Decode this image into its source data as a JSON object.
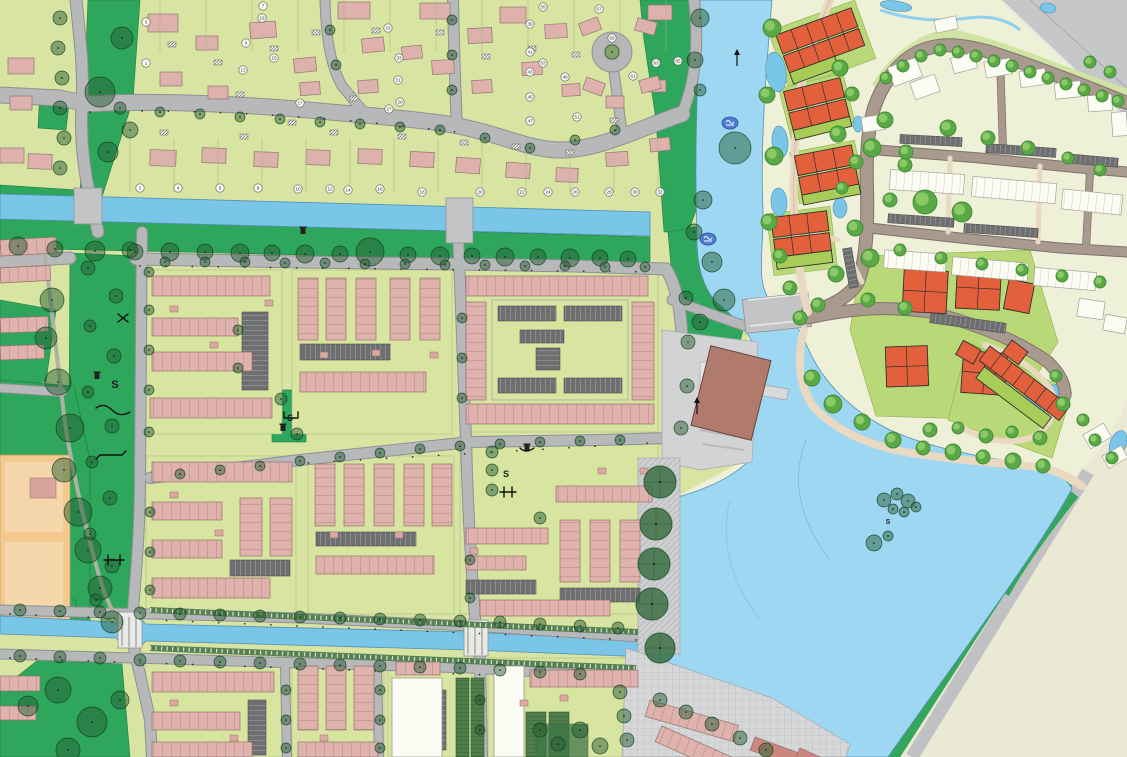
{
  "map": {
    "kind": "urban-masterplan-map",
    "labels": {
      "playground_letter": "S"
    },
    "s_labels": [
      {
        "text": "S",
        "x": 115,
        "y": 388,
        "size": 11
      },
      {
        "text": "S",
        "x": 290,
        "y": 421,
        "size": 9
      },
      {
        "text": "S",
        "x": 506,
        "y": 477,
        "size": 9
      },
      {
        "text": "S",
        "x": 888,
        "y": 524,
        "size": 7
      }
    ],
    "plot_numbers": [
      {
        "n": "3",
        "x": 146,
        "y": 22
      },
      {
        "n": "1",
        "x": 146,
        "y": 63
      },
      {
        "n": "9",
        "x": 246,
        "y": 43
      },
      {
        "n": "13",
        "x": 243,
        "y": 70
      },
      {
        "n": "15",
        "x": 274,
        "y": 58
      },
      {
        "n": "7",
        "x": 263,
        "y": 6
      },
      {
        "n": "19",
        "x": 262,
        "y": 18
      },
      {
        "n": "17",
        "x": 300,
        "y": 103
      },
      {
        "n": "23",
        "x": 388,
        "y": 28
      },
      {
        "n": "33",
        "x": 399,
        "y": 58
      },
      {
        "n": "31",
        "x": 398,
        "y": 80
      },
      {
        "n": "29",
        "x": 400,
        "y": 102
      },
      {
        "n": "27",
        "x": 389,
        "y": 109
      },
      {
        "n": "2",
        "x": 140,
        "y": 188
      },
      {
        "n": "4",
        "x": 178,
        "y": 188
      },
      {
        "n": "6",
        "x": 220,
        "y": 188
      },
      {
        "n": "8",
        "x": 258,
        "y": 188
      },
      {
        "n": "10",
        "x": 298,
        "y": 189
      },
      {
        "n": "12",
        "x": 330,
        "y": 189
      },
      {
        "n": "14",
        "x": 348,
        "y": 190
      },
      {
        "n": "16",
        "x": 380,
        "y": 189
      },
      {
        "n": "18",
        "x": 422,
        "y": 192
      },
      {
        "n": "20",
        "x": 480,
        "y": 192
      },
      {
        "n": "22",
        "x": 522,
        "y": 192
      },
      {
        "n": "24",
        "x": 548,
        "y": 192
      },
      {
        "n": "26",
        "x": 575,
        "y": 192
      },
      {
        "n": "28",
        "x": 609,
        "y": 192
      },
      {
        "n": "30",
        "x": 635,
        "y": 192
      },
      {
        "n": "32",
        "x": 660,
        "y": 192
      },
      {
        "n": "39",
        "x": 530,
        "y": 24
      },
      {
        "n": "41",
        "x": 530,
        "y": 52
      },
      {
        "n": "43",
        "x": 530,
        "y": 72
      },
      {
        "n": "45",
        "x": 530,
        "y": 97
      },
      {
        "n": "47",
        "x": 530,
        "y": 121
      },
      {
        "n": "49",
        "x": 565,
        "y": 77
      },
      {
        "n": "51",
        "x": 577,
        "y": 117
      },
      {
        "n": "53",
        "x": 543,
        "y": 63
      },
      {
        "n": "55",
        "x": 543,
        "y": 7
      },
      {
        "n": "57",
        "x": 599,
        "y": 9
      },
      {
        "n": "59",
        "x": 612,
        "y": 38
      },
      {
        "n": "61",
        "x": 633,
        "y": 76
      },
      {
        "n": "63",
        "x": 656,
        "y": 63
      },
      {
        "n": "65",
        "x": 678,
        "y": 61
      }
    ],
    "markers": [
      {
        "x": 730,
        "y": 123
      },
      {
        "x": 708,
        "y": 239
      }
    ],
    "arrows": [
      {
        "x": 737,
        "y": 66
      },
      {
        "x": 697,
        "y": 414
      }
    ],
    "bins": [
      {
        "x": 303,
        "y": 230
      },
      {
        "x": 97,
        "y": 375
      },
      {
        "x": 283,
        "y": 427
      },
      {
        "x": 527,
        "y": 447
      }
    ],
    "colors": {
      "existing_lots": "#d8e5a2",
      "new_dev_bg": "#eef0d7",
      "undeveloped": "#eae9d4",
      "park_green": "#2ea65c",
      "lawn_new": "#b9d877",
      "water_canal": "#79c6e9",
      "water_lake": "#9dd7f2",
      "road_gray": "#b7b8ba",
      "road_new": "#a89a8f",
      "path_cream": "#e9d9c1",
      "roof_pink": "#deb1ac",
      "roof_orange": "#e2613c",
      "roof_white": "#fcfcf5",
      "roof_brown": "#b07a6d",
      "parking_dark": "#6d6f71",
      "sports_field": "#f3c98e",
      "marker_blue": "#4f7fd0",
      "gray_band": "#c6c7c9"
    }
  }
}
